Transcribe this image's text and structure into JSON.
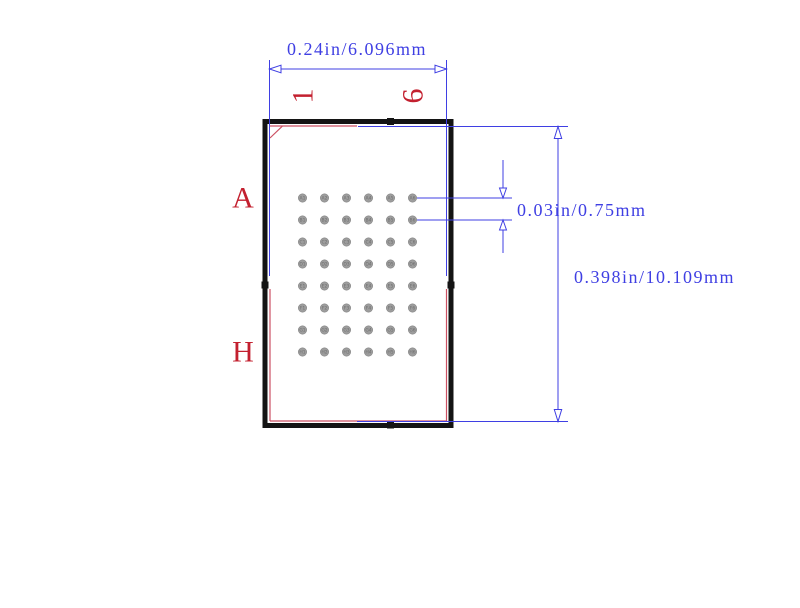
{
  "dimensions": {
    "width": {
      "label": "0.24in/6.096mm"
    },
    "ball_pitch": {
      "label": "0.03in/0.75mm"
    },
    "height": {
      "label": "0.398in/10.109mm"
    }
  },
  "axis_labels": {
    "col_first": "1",
    "col_last": "6",
    "row_first": "A",
    "row_last": "H"
  },
  "grid": {
    "col_labels": [
      "1",
      "2",
      "3",
      "4",
      "5",
      "6"
    ],
    "row_labels": [
      "A",
      "B",
      "C",
      "D",
      "E",
      "F",
      "G",
      "H"
    ],
    "ball_count": 48
  },
  "colors": {
    "dimension_blue": "#3f3fe3",
    "silkscreen_red": "#cc5163",
    "label_red": "#c3202f",
    "outline_black": "#141414",
    "ball_gray": "#9d9d9d"
  }
}
